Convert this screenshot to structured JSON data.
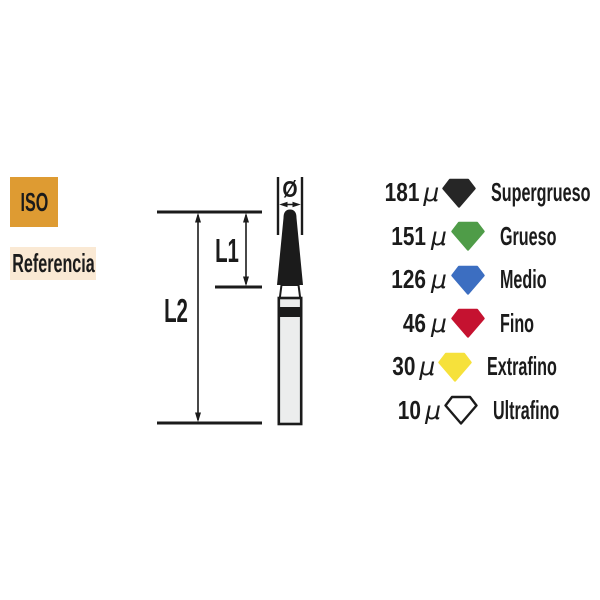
{
  "badges": {
    "iso_label": "ISO",
    "referencia_label": "Referencia"
  },
  "diagram": {
    "diameter_symbol": "Ø",
    "l1_label": "L1",
    "l2_label": "L2"
  },
  "legend": {
    "unit": "μ",
    "items": [
      {
        "value": "181",
        "grit": "Supergrueso",
        "color": "#262626",
        "outline": "#262626",
        "icon": "diamond-black"
      },
      {
        "value": "151",
        "grit": "Grueso",
        "color": "#4F9C48",
        "outline": "#4F9C48",
        "icon": "diamond-green"
      },
      {
        "value": "126",
        "grit": "Medio",
        "color": "#3C6EC1",
        "outline": "#3C6EC1",
        "icon": "diamond-blue"
      },
      {
        "value": "46",
        "grit": "Fino",
        "color": "#C51230",
        "outline": "#C51230",
        "icon": "diamond-red"
      },
      {
        "value": "30",
        "grit": "Extrafino",
        "color": "#F6E13B",
        "outline": "#F6E13B",
        "icon": "diamond-yellow"
      },
      {
        "value": "10",
        "grit": "Ultrafino",
        "color": "#FFFFFF",
        "outline": "#1B1B1B",
        "icon": "diamond-white"
      }
    ]
  },
  "colors": {
    "iso_bg": "#DE9B32",
    "referencia_bg": "#FAE9D4",
    "ink": "#1B1B1B",
    "shank_fill": "#ECEDED"
  }
}
